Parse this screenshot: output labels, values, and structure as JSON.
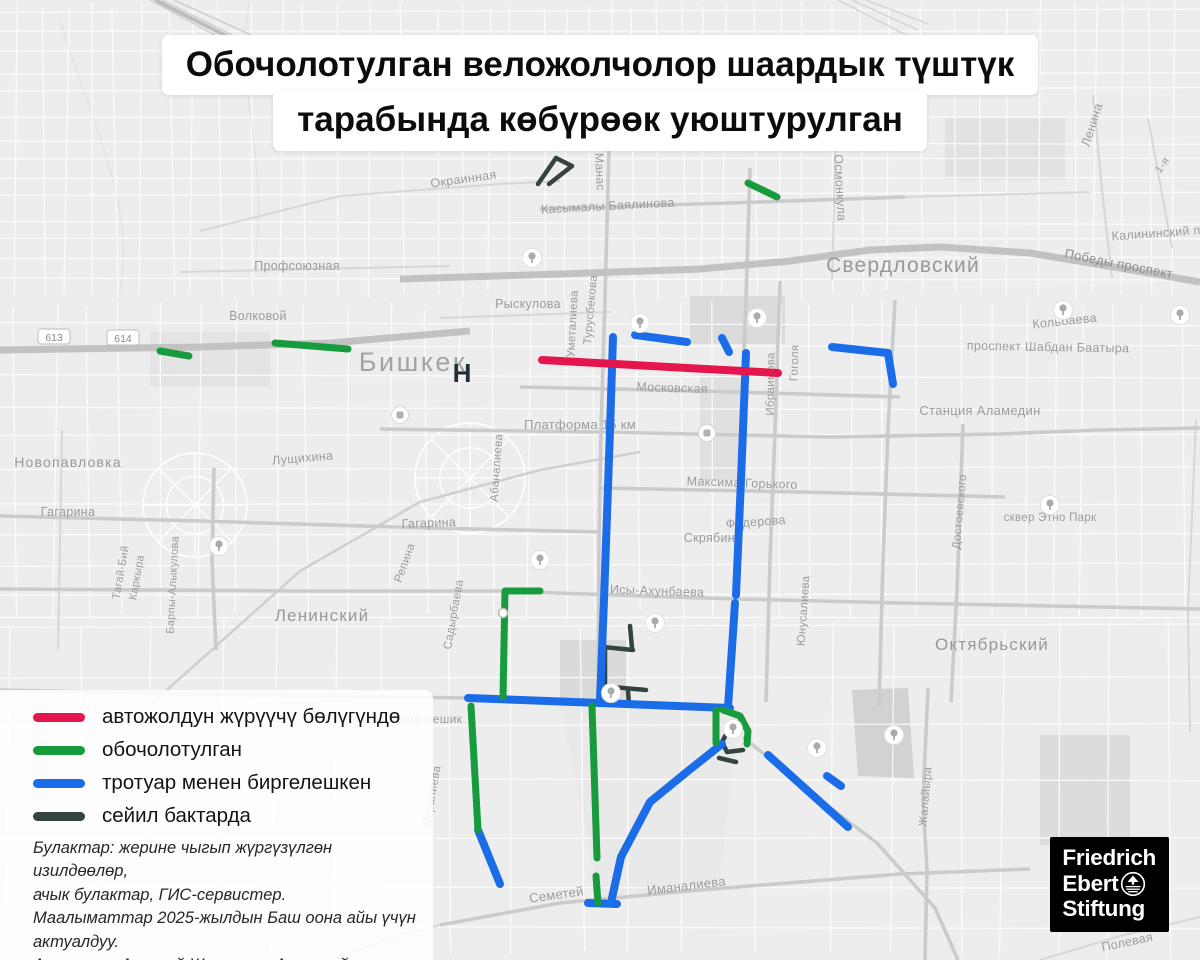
{
  "title": {
    "line1": "Обочолотулган веложолчолор шаардык түштүк",
    "line2": "тарабында көбүрөөк уюштурулган"
  },
  "legend": {
    "items": [
      {
        "id": "red",
        "color": "#e4164d",
        "label": "автожолдун жүрүүчү бөлүгүндө"
      },
      {
        "id": "green",
        "color": "#179b3d",
        "label": "обочолотулган"
      },
      {
        "id": "blue",
        "color": "#1a6ce8",
        "label": "тротуар менен биргелешкен"
      },
      {
        "id": "dark",
        "color": "#324340",
        "label": "сейил бактарда"
      }
    ]
  },
  "sources": {
    "lines": [
      "Булактар: жерине чыгып жүргүзүлгөн изилдөөлөр,",
      "ачык булактар, ГИС-сервистер.",
      "Маалыматтар 2025-жылдын Баш оона айы үчүн",
      "актуалдуу.",
      "Авторлор: Алексей Журавлев, Алтынай Ногойбаева"
    ]
  },
  "logo": {
    "lines": [
      "Friedrich",
      "Ebert",
      "Stiftung"
    ]
  },
  "map": {
    "city_label": {
      "t": "Бишкек",
      "x": 413,
      "y": 371,
      "s": 27
    },
    "district_labels": [
      {
        "t": "Свердловский",
        "x": 903,
        "y": 272,
        "s": 21
      },
      {
        "t": "Октябрьский",
        "x": 992,
        "y": 650,
        "s": 17
      },
      {
        "t": "Ленинский",
        "x": 322,
        "y": 621,
        "s": 17
      },
      {
        "t": "Новопавловка",
        "x": 68,
        "y": 467,
        "s": 14
      }
    ],
    "street_labels": [
      {
        "t": "Окраинная",
        "x": 464,
        "y": 183,
        "r": -8
      },
      {
        "t": "Касымалы Баялинова",
        "x": 608,
        "y": 210,
        "r": -3
      },
      {
        "t": "Манас",
        "x": 596,
        "y": 172,
        "r": 87,
        "s": 12
      },
      {
        "t": "Осмонкула",
        "x": 836,
        "y": 188,
        "r": 87
      },
      {
        "t": "Ленина",
        "x": 1096,
        "y": 126,
        "r": -72
      },
      {
        "t": "1-я",
        "x": 1165,
        "y": 167,
        "r": -55,
        "s": 11
      },
      {
        "t": "Калининский пр",
        "x": 1160,
        "y": 237,
        "r": -4
      },
      {
        "t": "Победы проспект",
        "x": 1118,
        "y": 268,
        "r": 11,
        "s": 13,
        "c": "#8d8d8d"
      },
      {
        "t": "Кольбаева",
        "x": 1065,
        "y": 325,
        "r": -6
      },
      {
        "t": "проспект Шабдан Баатыра",
        "x": 1048,
        "y": 351,
        "r": 1
      },
      {
        "t": "Профсоюзная",
        "x": 297,
        "y": 270
      },
      {
        "t": "Волковой",
        "x": 258,
        "y": 320
      },
      {
        "t": "Рыскулова",
        "x": 528,
        "y": 308
      },
      {
        "t": "Уметалиева",
        "x": 576,
        "y": 324,
        "r": -87,
        "s": 11.5
      },
      {
        "t": "Турусбекова",
        "x": 594,
        "y": 310,
        "r": -85,
        "s": 11.5
      },
      {
        "t": "Московская",
        "x": 672,
        "y": 392,
        "r": 2
      },
      {
        "t": "Гоголя",
        "x": 798,
        "y": 363,
        "r": -88,
        "s": 11.5
      },
      {
        "t": "Ибраимова",
        "x": 774,
        "y": 384,
        "r": -89,
        "s": 11.5
      },
      {
        "t": "Станция Аламедин",
        "x": 980,
        "y": 415,
        "s": 13
      },
      {
        "t": "Платформа 15 км",
        "x": 580,
        "y": 429,
        "s": 13
      },
      {
        "t": "Лущихина",
        "x": 303,
        "y": 462,
        "r": -5
      },
      {
        "t": "Гагарина",
        "x": 68,
        "y": 516
      },
      {
        "t": "Гагарина",
        "x": 429,
        "y": 527,
        "r": -2
      },
      {
        "t": "Максима-Горького",
        "x": 742,
        "y": 487,
        "r": 2
      },
      {
        "t": "Федерова",
        "x": 756,
        "y": 526,
        "r": -4
      },
      {
        "t": "Скрябина",
        "x": 713,
        "y": 542
      },
      {
        "t": "сквер Этно Парк",
        "x": 1050,
        "y": 521,
        "s": 11.5
      },
      {
        "t": "Достоевского",
        "x": 963,
        "y": 512,
        "r": -85,
        "s": 11.5
      },
      {
        "t": "Исы-Ахунбаева",
        "x": 657,
        "y": 595,
        "r": 2
      },
      {
        "t": "Юнусалиева",
        "x": 807,
        "y": 611,
        "r": -86,
        "s": 11.5
      },
      {
        "t": "Тагай-Бий",
        "x": 124,
        "y": 573,
        "r": -80,
        "s": 11
      },
      {
        "t": "Каркыра",
        "x": 140,
        "y": 578,
        "r": -80,
        "s": 11
      },
      {
        "t": "Барпы-Алыкулова",
        "x": 176,
        "y": 585,
        "r": -87,
        "s": 11
      },
      {
        "t": "Репина",
        "x": 408,
        "y": 564,
        "r": -70,
        "s": 11.5
      },
      {
        "t": "Садырбаева",
        "x": 457,
        "y": 615,
        "r": -80,
        "s": 11.5
      },
      {
        "t": "Абаналиева",
        "x": 500,
        "y": 468,
        "r": -86,
        "s": 11.5
      },
      {
        "t": "сквер Арча-Бешик",
        "x": 409,
        "y": 723,
        "s": 12
      },
      {
        "t": "Шералиева",
        "x": 435,
        "y": 798,
        "r": -80,
        "s": 11.5
      },
      {
        "t": "Семетей",
        "x": 557,
        "y": 899,
        "r": -8,
        "s": 13
      },
      {
        "t": "Иманалиева",
        "x": 687,
        "y": 890,
        "r": -7,
        "s": 13
      },
      {
        "t": "Жалайыра",
        "x": 929,
        "y": 797,
        "r": -85,
        "s": 11.5
      },
      {
        "t": "Полевая",
        "x": 1128,
        "y": 946,
        "r": -12
      }
    ],
    "shields": [
      {
        "t": "613",
        "x": 54,
        "y": 337
      },
      {
        "t": "614",
        "x": 123,
        "y": 338
      }
    ],
    "h_marker": {
      "t": "Н",
      "x": 462,
      "y": 382
    },
    "routes": {
      "red": [
        [
          [
            542,
            360
          ],
          [
            778,
            373
          ]
        ]
      ],
      "green": [
        [
          [
            160,
            351
          ],
          [
            189,
            356
          ]
        ],
        [
          [
            275,
            343
          ],
          [
            348,
            349
          ]
        ],
        [
          [
            748,
            183
          ],
          [
            777,
            197
          ]
        ],
        [
          [
            540,
            591
          ],
          [
            505,
            591
          ],
          [
            503,
            697
          ]
        ],
        [
          [
            471,
            706
          ],
          [
            478,
            830
          ]
        ],
        [
          [
            592,
            706
          ],
          [
            597,
            858
          ]
        ],
        [
          [
            596,
            876
          ],
          [
            598,
            903
          ]
        ],
        [
          [
            716,
            710
          ],
          [
            716,
            743
          ]
        ],
        [
          [
            723,
            710
          ],
          [
            740,
            716
          ],
          [
            748,
            731
          ],
          [
            747,
            744
          ]
        ]
      ],
      "blue": [
        [
          [
            613,
            337
          ],
          [
            610,
            430
          ],
          [
            604,
            600
          ],
          [
            600,
            700
          ]
        ],
        [
          [
            746,
            353
          ],
          [
            741,
            480
          ],
          [
            736,
            595
          ]
        ],
        [
          [
            735,
            603
          ],
          [
            728,
            707
          ]
        ],
        [
          [
            635,
            335
          ],
          [
            687,
            342
          ]
        ],
        [
          [
            722,
            338
          ],
          [
            729,
            352
          ]
        ],
        [
          [
            832,
            347
          ],
          [
            888,
            353
          ],
          [
            893,
            384
          ]
        ],
        [
          [
            468,
            698
          ],
          [
            600,
            703
          ],
          [
            730,
            708
          ]
        ],
        [
          [
            722,
            744
          ],
          [
            688,
            771
          ],
          [
            650,
            802
          ],
          [
            621,
            857
          ],
          [
            612,
            898
          ]
        ],
        [
          [
            588,
            903
          ],
          [
            617,
            904
          ]
        ],
        [
          [
            478,
            830
          ],
          [
            500,
            884
          ]
        ],
        [
          [
            768,
            755
          ],
          [
            848,
            827
          ]
        ],
        [
          [
            827,
            776
          ],
          [
            841,
            786
          ]
        ]
      ],
      "dark": [
        [
          [
            538,
            184
          ],
          [
            556,
            158
          ],
          [
            572,
            166
          ],
          [
            549,
            184
          ]
        ],
        [
          [
            630,
            626
          ],
          [
            632,
            648
          ]
        ],
        [
          [
            603,
            647
          ],
          [
            633,
            650
          ]
        ],
        [
          [
            605,
            650
          ],
          [
            605,
            687
          ]
        ],
        [
          [
            601,
            686
          ],
          [
            646,
            690
          ]
        ],
        [
          [
            628,
            690
          ],
          [
            629,
            706
          ]
        ],
        [
          [
            740,
            726
          ],
          [
            728,
            731
          ],
          [
            722,
            742
          ],
          [
            727,
            752
          ],
          [
            743,
            750
          ]
        ],
        [
          [
            719,
            758
          ],
          [
            736,
            762
          ]
        ]
      ]
    },
    "trees": [
      [
        219,
        546
      ],
      [
        532,
        258
      ],
      [
        640,
        323
      ],
      [
        757,
        318
      ],
      [
        1063,
        310
      ],
      [
        1180,
        315
      ],
      [
        1050,
        505
      ],
      [
        540,
        560
      ],
      [
        655,
        623
      ],
      [
        611,
        693
      ],
      [
        733,
        729
      ],
      [
        894,
        735
      ],
      [
        817,
        748
      ]
    ],
    "transit": [
      [
        400,
        415
      ],
      [
        707,
        433
      ]
    ],
    "junctions": [
      [
        503,
        613
      ]
    ]
  }
}
